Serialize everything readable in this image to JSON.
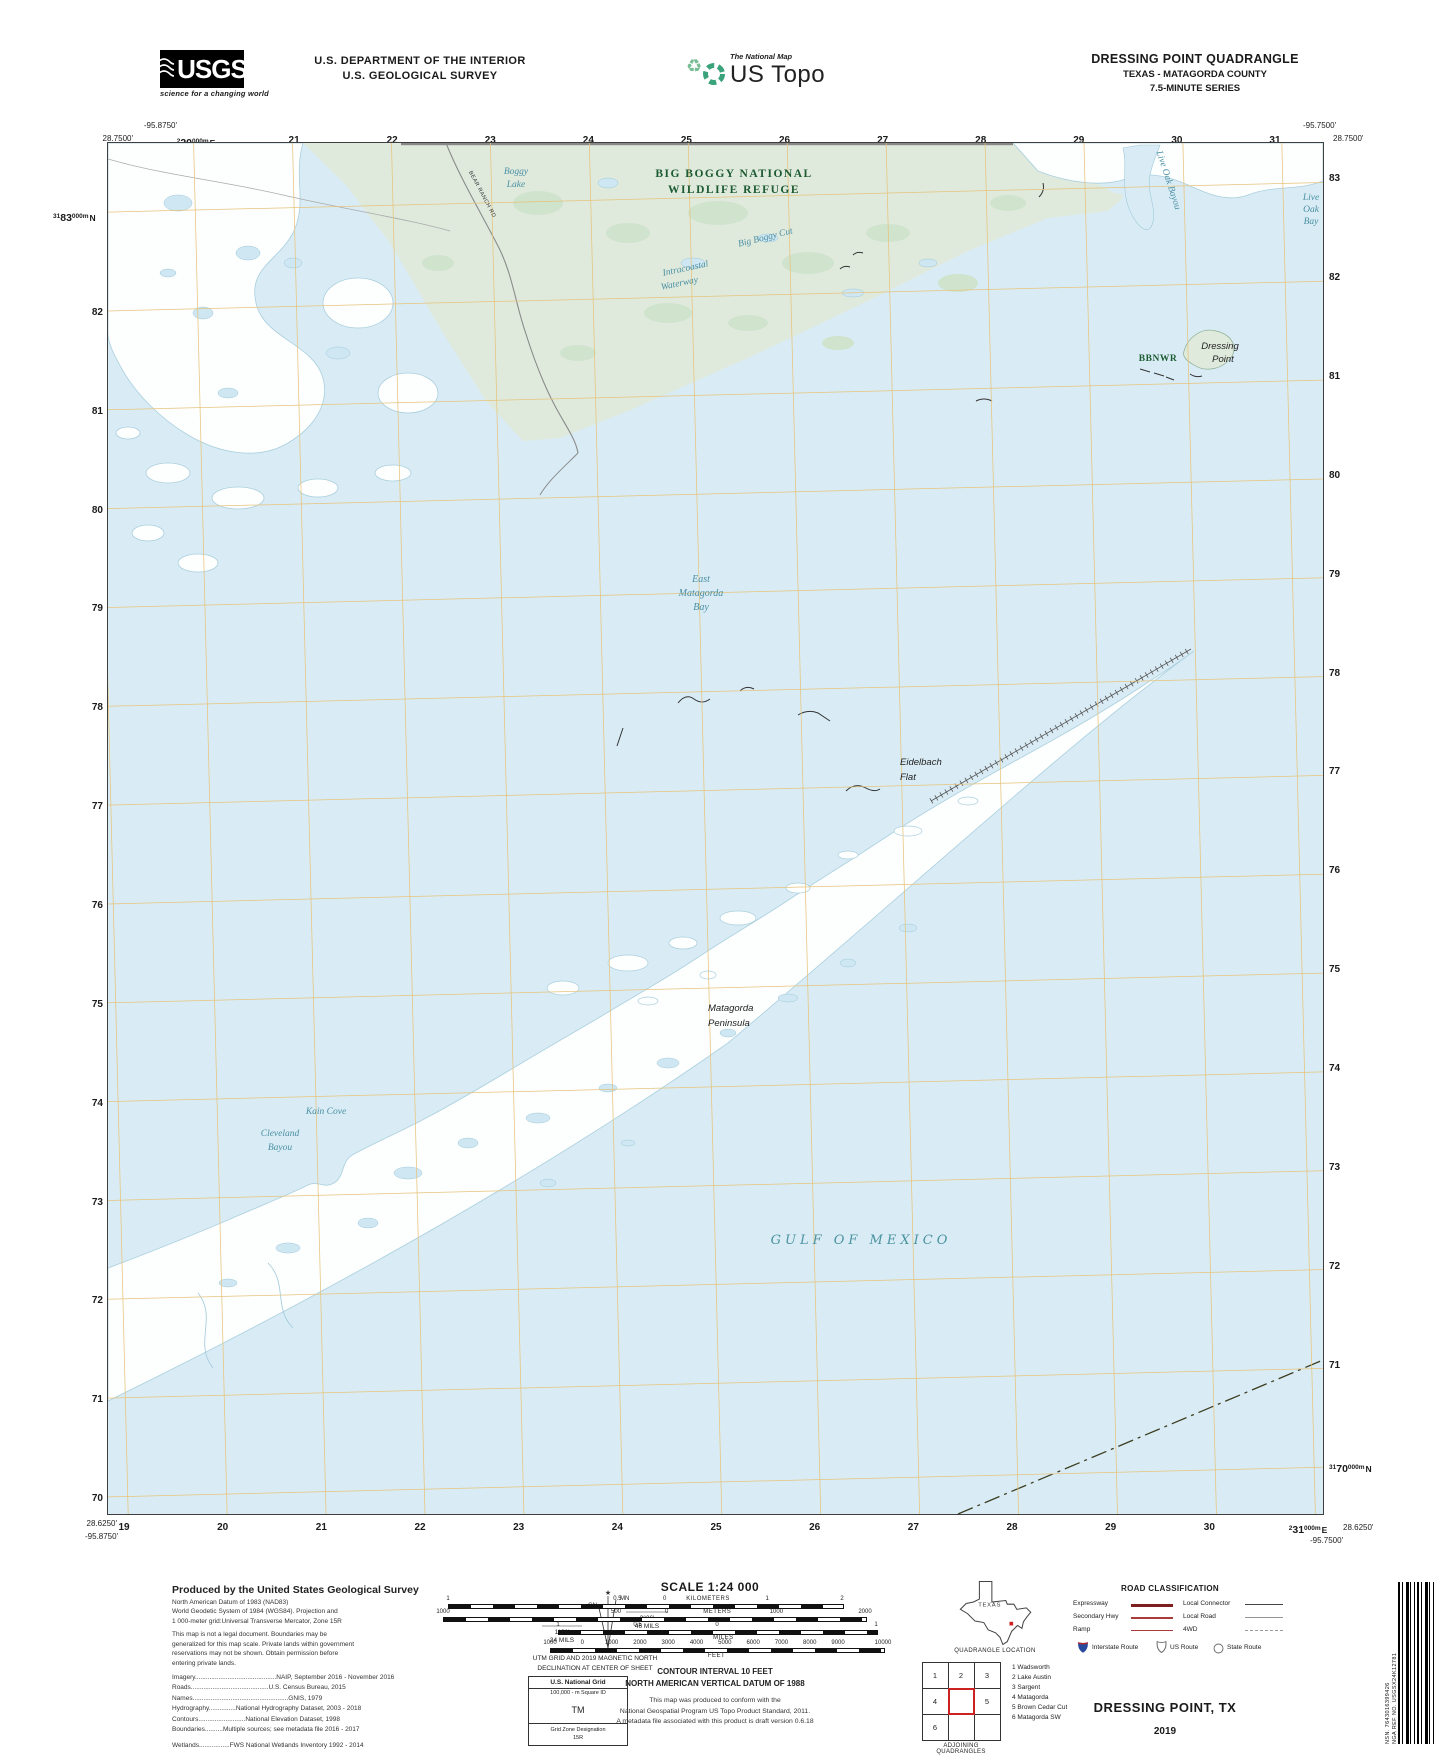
{
  "header": {
    "usgs_logo": "USGS",
    "usgs_tagline": "science for a changing world",
    "dept_line1": "U.S. DEPARTMENT OF THE INTERIOR",
    "dept_line2": "U.S. GEOLOGICAL SURVEY",
    "natmap_small": "The National Map",
    "natmap_large": "US Topo",
    "quad_title": "DRESSING POINT QUADRANGLE",
    "quad_sub1": "TEXAS - MATAGORDA COUNTY",
    "quad_sub2": "7.5-MINUTE SERIES"
  },
  "map": {
    "corners": {
      "top_left_lon": "-95.8750'",
      "top_left_lat": "28.7500'",
      "top_right_lon": "-95.7500'",
      "top_right_lat": "28.7500'",
      "bottom_left_lat": "28.6250'",
      "bottom_left_lon": "-95.8750'",
      "bottom_right_lat": "28.6250'",
      "bottom_right_lon": "-95.7500'"
    },
    "grid": {
      "top_first": {
        "sup": "2",
        "main": "20",
        "sup2": "000m",
        "dir": "E"
      },
      "top_numbers": [
        "21",
        "22",
        "23",
        "24",
        "25",
        "26",
        "27",
        "28",
        "29",
        "30",
        "31"
      ],
      "bottom_numbers": [
        "19",
        "20",
        "21",
        "22",
        "23",
        "24",
        "25",
        "26",
        "27",
        "28",
        "29",
        "30"
      ],
      "bottom_last": {
        "sup": "2",
        "main": "31",
        "sup2": "000m",
        "dir": "E"
      },
      "left_first": {
        "sup": "31",
        "main": "83",
        "sup2": "000m",
        "dir": "N"
      },
      "left_numbers": [
        "82",
        "81",
        "80",
        "79",
        "78",
        "77",
        "76",
        "75",
        "74",
        "73",
        "72",
        "71",
        "70"
      ],
      "right_numbers": [
        "83",
        "82",
        "81",
        "80",
        "79",
        "78",
        "77",
        "76",
        "75",
        "74",
        "73",
        "72",
        "71"
      ],
      "right_last": {
        "sup": "31",
        "main": "70",
        "sup2": "000m",
        "dir": "N"
      }
    },
    "labels": {
      "refuge": [
        "BIG BOGGY NATIONAL",
        "WILDLIFE REFUGE"
      ],
      "boggy_lake": [
        "Boggy",
        "Lake"
      ],
      "bear_ranch_rd": "BEAR RANCH RD",
      "big_boggy_cut": "Big Boggy Cut",
      "intracoastal": [
        "Intracoastal",
        "Waterway"
      ],
      "live_oak_bayou": "Live Oak Bayou",
      "live_oak_bay": [
        "Live",
        "Oak",
        "Bay"
      ],
      "bbnwr": "BBNWR",
      "dressing_point": [
        "Dressing",
        "Point"
      ],
      "east_matagorda_bay": [
        "East",
        "Matagorda",
        "Bay"
      ],
      "eidelbach_flat": [
        "Eidelbach",
        "Flat"
      ],
      "matagorda_peninsula": [
        "Matagorda",
        "Peninsula"
      ],
      "kain_cove": "Kain Cove",
      "cleveland_bayou": [
        "Cleveland",
        "Bayou"
      ],
      "gulf_of_mexico": "GULF OF MEXICO"
    },
    "colors": {
      "water": "#d9ecf5",
      "land": "#fdfefe",
      "refuge_green": "#dfeadd",
      "grid_line": "#e6c47c",
      "water_label": "#4b8fa3",
      "refuge_label": "#1c5a31"
    }
  },
  "footer": {
    "left": {
      "title": "Produced by the United States Geological Survey",
      "datum_lines": [
        "North American Datum of 1983 (NAD83)",
        "World Geodetic System of 1984 (WGS84).  Projection and",
        "1 000-meter grid:Universal Transverse Mercator, Zone 15R"
      ],
      "legal_lines": [
        "This map is not a legal document. Boundaries may be",
        "generalized for this map scale. Private lands within government",
        "reservations may not be shown. Obtain permission before",
        "entering private lands."
      ],
      "credits": [
        "Imagery.............................................NAIP, September 2016 - November 2016",
        "Roads...........................................U.S. Census Bureau,  2015",
        "Names.....................................................GNIS,  1979",
        "Hydrography...............National Hydrography Dataset, 2003 - 2018",
        "Contours..........................National Elevation Dataset,  1998",
        "Boundaries..........Multiple sources; see metadata file 2016 - 2017"
      ],
      "wetlands": "Wetlands.................FWS National Wetlands Inventory 1992 - 2014"
    },
    "declination": {
      "star": "★",
      "mn": "MN",
      "gn": "GN",
      "mn_deg": "2°36'",
      "mn_mils": "46 MILS",
      "gn_deg": "1°21'",
      "gn_mils": "24 MILS",
      "caption": [
        "UTM GRID AND 2019 MAGNETIC NORTH",
        "DECLINATION AT CENTER OF SHEET"
      ]
    },
    "usng": {
      "title": "U.S. National Grid",
      "square_label": "100,000 - m Square ID",
      "square_id": "TM",
      "zone_label": "Grid Zone Designation",
      "zone": "15R"
    },
    "scale": {
      "title": "SCALE 1:24 000",
      "bars": [
        {
          "unit": "KILOMETERS",
          "unit_frac": 0.66,
          "unit_below": false,
          "x0": 18,
          "x1": 412,
          "labels": [
            {
              "t": "1",
              "f": 0
            },
            {
              "t": "0.5",
              "f": 0.43
            },
            {
              "t": "0",
              "f": 0.55
            },
            {
              "t": "1",
              "f": 0.81
            },
            {
              "t": "2",
              "f": 1
            }
          ]
        },
        {
          "unit": "METERS",
          "unit_frac": 0.65,
          "unit_below": false,
          "x0": 13,
          "x1": 435,
          "labels": [
            {
              "t": "1000",
              "f": 0
            },
            {
              "t": "500",
              "f": 0.41
            },
            {
              "t": "0",
              "f": 0.53
            },
            {
              "t": "1000",
              "f": 0.79
            },
            {
              "t": "2000",
              "f": 1
            }
          ]
        },
        {
          "unit": "MILES",
          "unit_frac": 0.52,
          "unit_below": true,
          "x0": 128,
          "x1": 446,
          "labels": [
            {
              "t": "1",
              "f": 0
            },
            {
              "t": "0.5",
              "f": 0.25
            },
            {
              "t": "0",
              "f": 0.5
            },
            {
              "t": "1",
              "f": 1
            }
          ]
        },
        {
          "unit": "FEET",
          "unit_frac": 0.5,
          "unit_below": true,
          "x0": 120,
          "x1": 453,
          "labels": [
            {
              "t": "1000",
              "f": 0
            },
            {
              "t": "0",
              "f": 0.097
            },
            {
              "t": "1000",
              "f": 0.185
            },
            {
              "t": "2000",
              "f": 0.27
            },
            {
              "t": "3000",
              "f": 0.355
            },
            {
              "t": "4000",
              "f": 0.44
            },
            {
              "t": "5000",
              "f": 0.525
            },
            {
              "t": "6000",
              "f": 0.61
            },
            {
              "t": "7000",
              "f": 0.695
            },
            {
              "t": "8000",
              "f": 0.78
            },
            {
              "t": "9000",
              "f": 0.865
            },
            {
              "t": "10000",
              "f": 1
            }
          ]
        }
      ],
      "contour_line1": "CONTOUR INTERVAL 10 FEET",
      "contour_line2": "NORTH AMERICAN VERTICAL DATUM OF 1988",
      "conform_lines": [
        "This map was produced to conform with the",
        "National Geospatial Program US Topo Product Standard, 2011.",
        "A metadata file associated with this product is draft version 0.6.18"
      ]
    },
    "texas": {
      "label": "TEXAS",
      "caption": "QUADRANGLE LOCATION"
    },
    "road_class": {
      "title": "ROAD CLASSIFICATION",
      "col1": [
        {
          "label": "Expressway",
          "style": "expressway"
        },
        {
          "label": "Secondary Hwy",
          "style": "secondary"
        },
        {
          "label": "Ramp",
          "style": "ramp"
        }
      ],
      "col2": [
        {
          "label": "Local Connector",
          "style": "local_connector"
        },
        {
          "label": "Local Road",
          "style": "local_road"
        },
        {
          "label": "4WD",
          "style": "fwd"
        }
      ],
      "interstate": "Interstate Route",
      "us_route": "US Route",
      "state_route": "State Route"
    },
    "adjoining": {
      "caption": "ADJOINING QUADRANGLES",
      "numbers": [
        "1",
        "2",
        "3",
        "4",
        "5",
        "6"
      ],
      "names": [
        "1 Wadsworth",
        "2 Lake Austin",
        "3 Sargent",
        "4 Matagorda",
        "5 Brown Cedar Cut",
        "6 Matagorda SW"
      ]
    },
    "sheet_name": "DRESSING POINT,  TX",
    "sheet_year": "2019",
    "barcode": {
      "nsn": "NSN. 7643016399426",
      "nga": "NGA REF NO. USGSX24K12781"
    }
  }
}
